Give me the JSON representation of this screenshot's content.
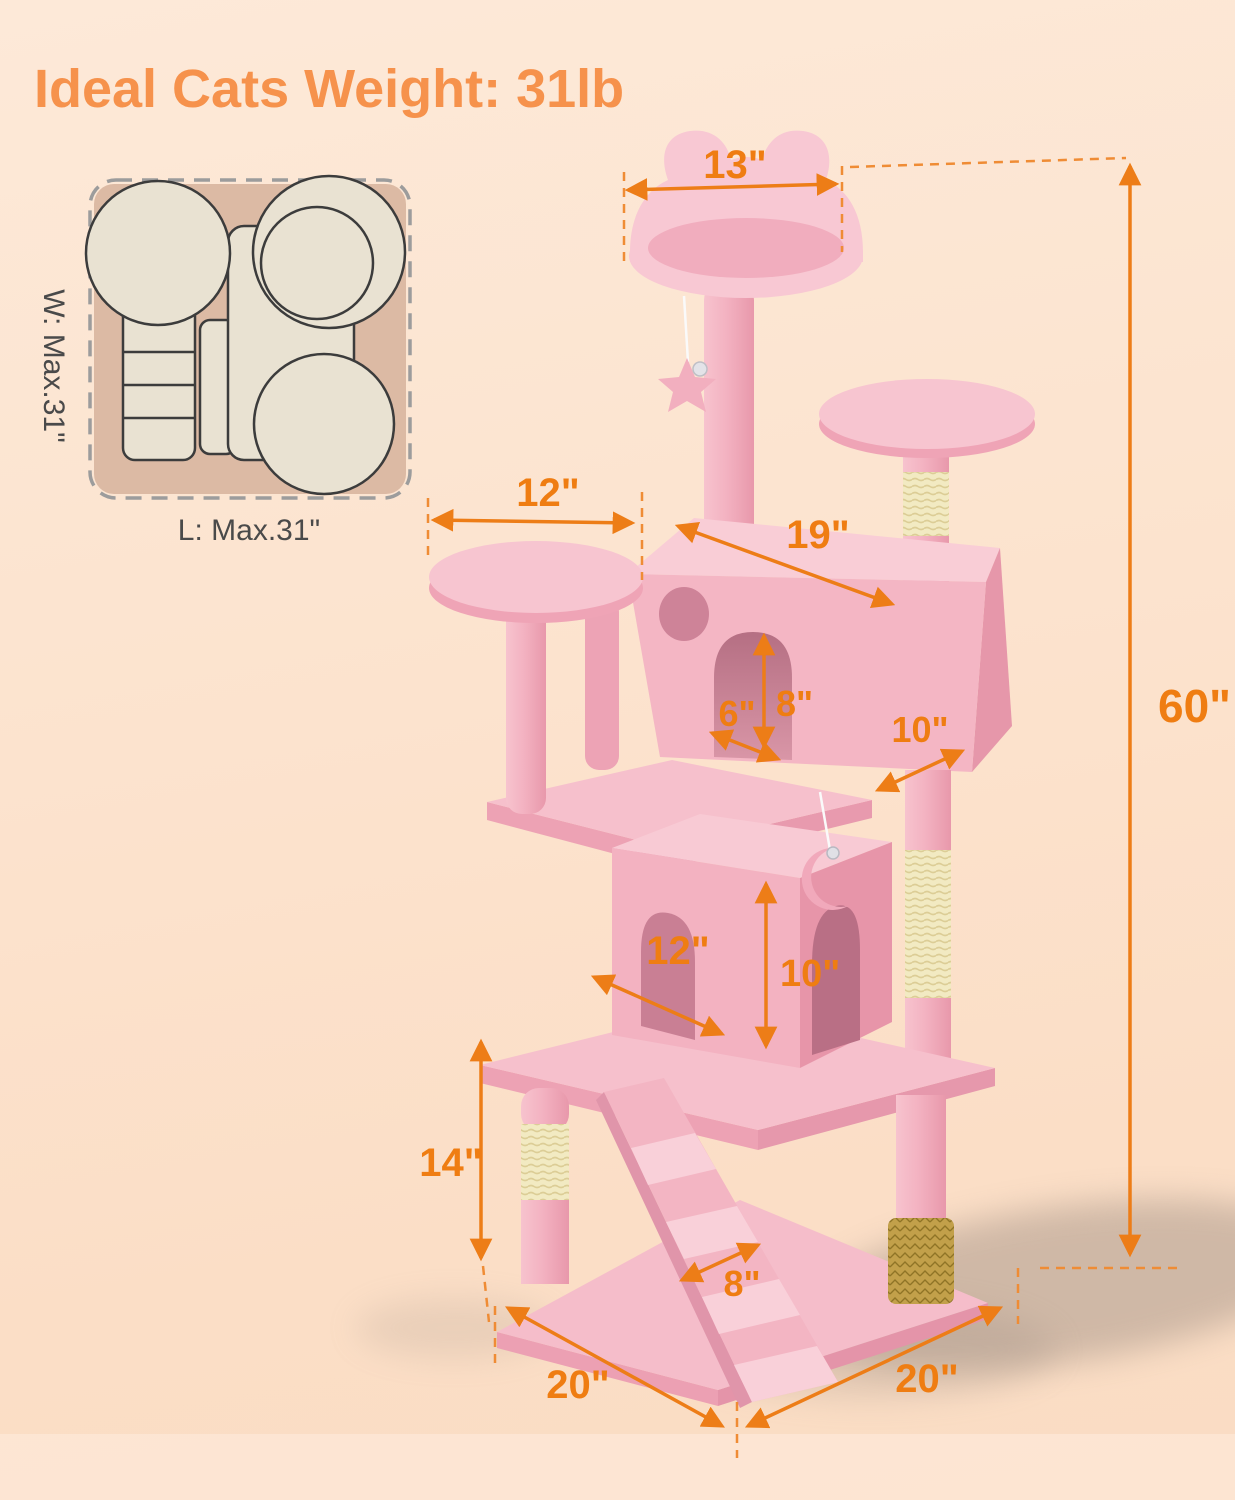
{
  "title": "Ideal Cats Weight: 31lb",
  "footprint": {
    "width": "W: Max.31\"",
    "length": "L: Max.31\""
  },
  "dims": {
    "top_perch_width": "13\"",
    "left_platform_width": "12\"",
    "condo_length": "19\"",
    "door_height": "8\"",
    "door_width": "6\"",
    "condo_depth": "10\"",
    "total_height": "60\"",
    "lower_condo_width": "12\"",
    "lower_condo_height": "10\"",
    "lower_post_height": "14\"",
    "ramp_width": "8\"",
    "base_length": "20\"",
    "base_depth": "20\""
  },
  "colors": {
    "accent_orange": "#EF7D12",
    "title_orange": "#F6924C",
    "plush_pink_light": "#F8CBD5",
    "plush_pink_mid": "#F4B6C4",
    "plush_pink_dark": "#E795A9",
    "sisal_cream": "#F2EAC2",
    "groomer_gold": "#C2A04A",
    "inset_tan": "#DCBAA4",
    "inset_cream": "#E9E2D2",
    "background_peach": "#FCE2CC"
  }
}
